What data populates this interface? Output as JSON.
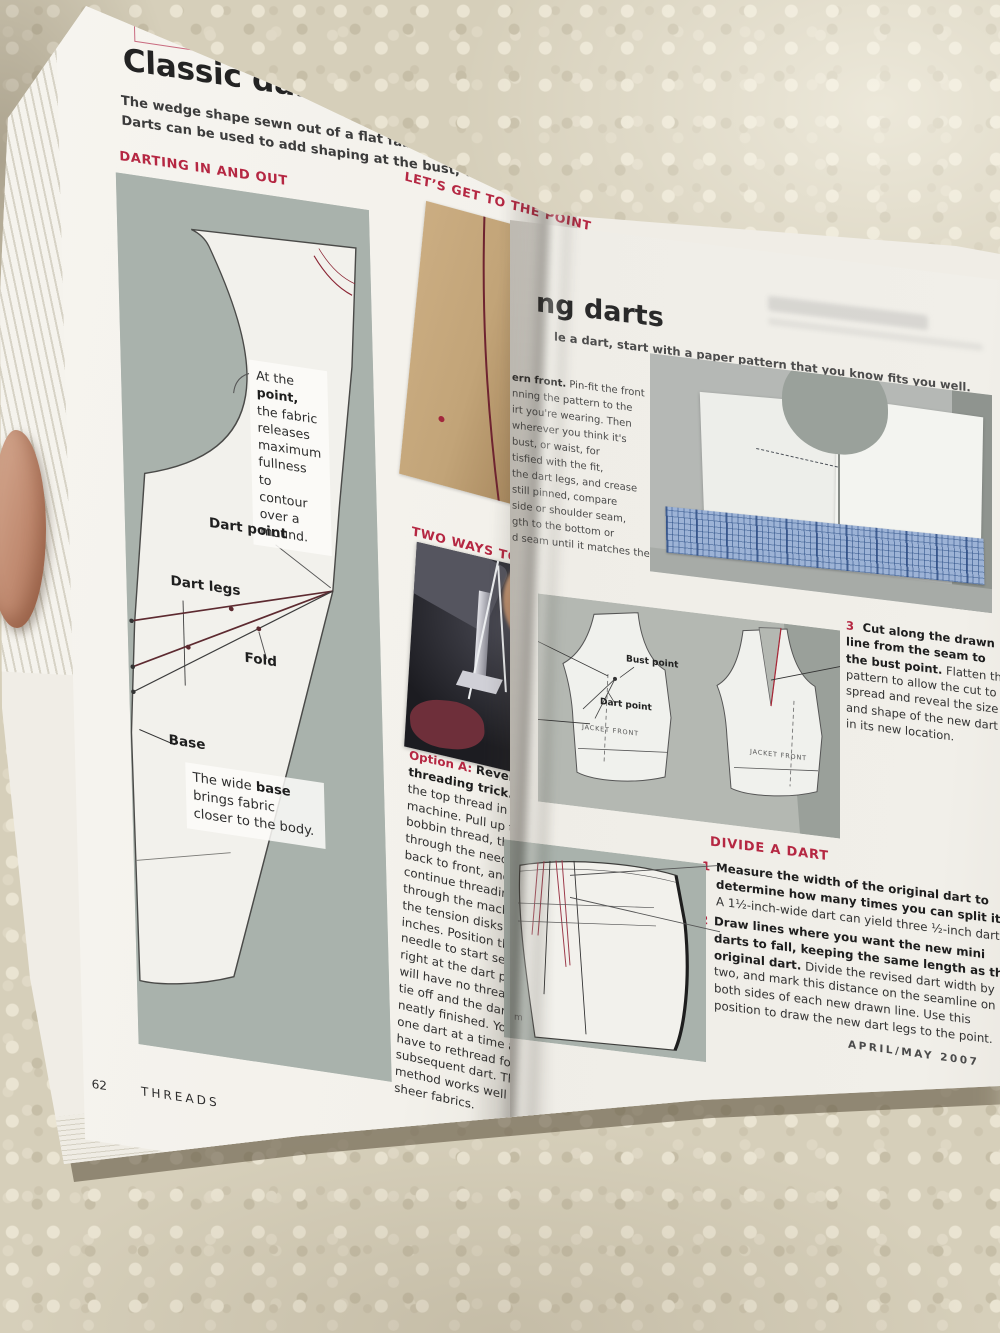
{
  "palette": {
    "accent_red": "#b52742",
    "sage_panel": "#a9b2ac",
    "page": "#f2f0ea",
    "carpet": "#d6cfba"
  },
  "left_page": {
    "kicker": "ART DARTS",
    "title": "Classic darts 101",
    "intro_line1": "The wedge shape sewn out of a flat fabric to contour it over a mound is called a",
    "intro_line2": "Darts can be used to add shaping at the bust, waist, hips, and shoulders.",
    "section1": "DARTING IN AND OUT",
    "diagram": {
      "point_note_pre": "At the",
      "point_note_bold": "point,",
      "point_note_rest": "the fabric releases maximum fullness to contour over a mound.",
      "dart_point": "Dart point",
      "dart_legs": "Dart legs",
      "fold": "Fold",
      "base": "Base",
      "base_note_pre": "The wide",
      "base_note_bold": "base",
      "base_note_rest": "brings fabric closer to the body."
    },
    "section2": "LET’S GET TO THE POINT",
    "side_fragments": [
      "Custo",
      "Dart l",
      "even",
      "sew da",
      "the se",
      "point",
      "stitch",
      "to len"
    ],
    "section3": "TWO WAYS TO SECURE THE POINT",
    "option_a": {
      "lead": "Option A:",
      "bold": "Reverse-threading trick.",
      "body": "Remove the top thread in your machine. Pull up the bobbin thread, thread it through the needle from back to front, and continue threading up through the machine past the tension disks about 10 inches. Position the needle to start sewing right at the dart point. You will have no thread tails to tie off and the dart is neatly finished. You sew one dart at a time and have to rethread for each subsequent dart. This method works well for sheer fabrics."
    },
    "page_number": "62",
    "magazine_name": "THREADS"
  },
  "right_page": {
    "title_fragment": "ng darts",
    "subtitle_fragment": "le a dart, start with a paper pattern that you know fits you well.",
    "col_frag1_bold": "ern front.",
    "col_frag1_rest": "Pin-fit the front",
    "col_fragments": [
      "nning the pattern to the",
      "irt you're wearing. Then",
      "wherever you think it's",
      "bust, or waist, for",
      "tisfied with the fit,",
      "the dart legs, and crease",
      "still pinned, compare",
      "side or shoulder seam,",
      "gth to the bottom or",
      "d seam until it matches the"
    ],
    "photo_labels": {
      "bust_point": "Bust point",
      "dart_point": "Dart point",
      "jacket_front_left": "JACKET FRONT",
      "jacket_front_right": "JACKET FRONT"
    },
    "step3": {
      "num": "3",
      "bold": "Cut along the drawn line from the seam to the bust point.",
      "rest": "Flatten the pattern to allow the cut to spread and reveal the size and shape of the new dart in its new location."
    },
    "divide_heading": "DIVIDE A DART",
    "step1": {
      "num": "1",
      "bold": "Measure the width of the original dart to determine how many times you can split it.",
      "rest": "A 1½-inch-wide dart can yield three ½-inch darts."
    },
    "step2": {
      "num": "2",
      "bold": "Draw lines where you want the new mini darts to fall, keeping the same length as the original dart.",
      "rest": "Divide the revised dart width by two, and mark this distance on the seamline on both sides of each new drawn line. Use this position to draw the new dart legs to the point."
    },
    "skirt_caption": "m",
    "footer": "APRIL/MAY 2007"
  }
}
